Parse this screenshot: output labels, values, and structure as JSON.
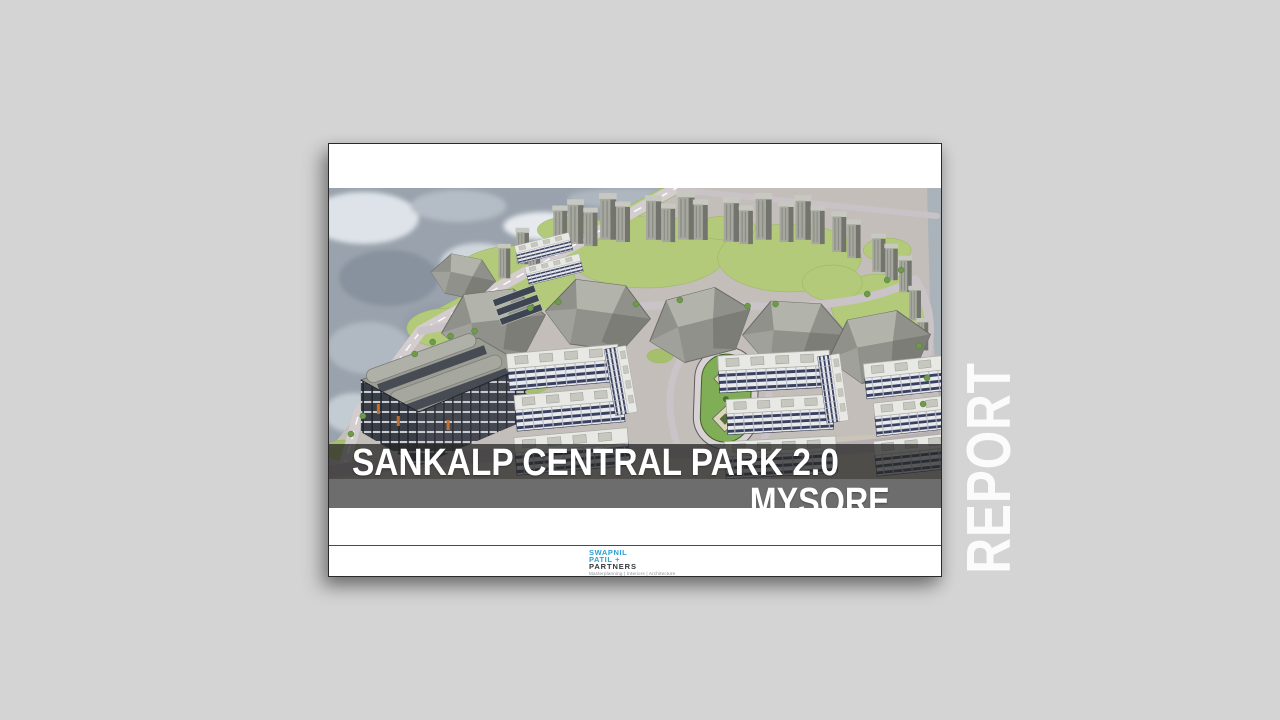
{
  "page": {
    "background": "#d4d4d4"
  },
  "side_label": {
    "text": "REPORT",
    "color": "#fbfbfb"
  },
  "slide": {
    "title": "SANKALP CENTRAL PARK 2.0",
    "location": "MYSORE",
    "render_caption": "Aerial 3D masterplan rendering: high-rise tower clusters on lawns, mid-rise residential blocks, central oval park, retail mall, satellite photo context",
    "colors": {
      "title_text": "#ffffff",
      "title_band": "rgba(38,38,38,0.75)",
      "location_band": "#6d6d6d"
    }
  },
  "logo": {
    "line1": "SWAPNIL",
    "line2": "PATIL +",
    "line3": "PARTNERS",
    "tagline": "Masterplanning | Interiors | Architecture",
    "accent": "#2b9fd3",
    "text_color": "#33363a"
  }
}
